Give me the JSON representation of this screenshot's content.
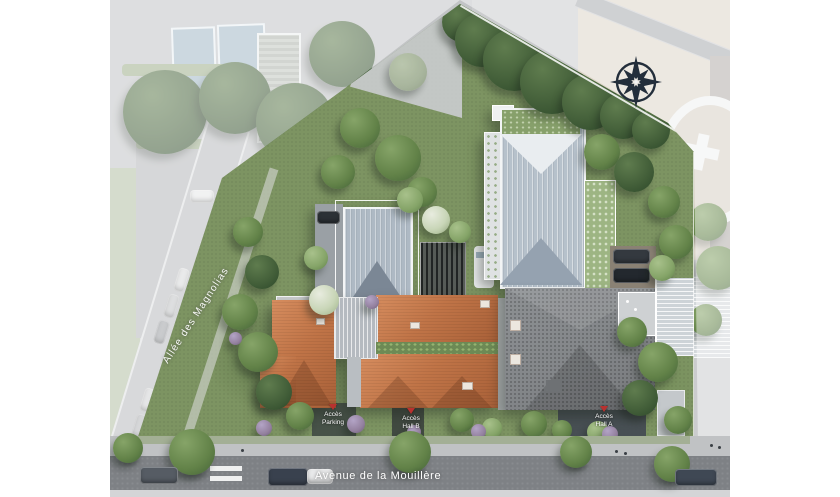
{
  "streets": {
    "avenue": "Avenue de la Mouillère",
    "allee": "Allée des Magnolias"
  },
  "access_points": [
    {
      "id": "parking",
      "line1": "Accès",
      "line2": "Parking"
    },
    {
      "id": "hall-b",
      "line1": "Accès",
      "line2": "Hall B"
    },
    {
      "id": "hall-a",
      "line1": "Accès",
      "line2": "Hall A"
    }
  ],
  "icons": {
    "compass_rose": "8-point compass star",
    "access_marker": "red downward arrow"
  },
  "colors": {
    "accent_red": "#b8312f",
    "site_green": "#7d9462",
    "roof_slate": "#b6c1cb",
    "roof_terracotta": "#c07447",
    "roof_dark_shingle": "#84878a",
    "road_asphalt": "#7e8185",
    "wash_white": "rgba(255,255,255,0.45)"
  }
}
